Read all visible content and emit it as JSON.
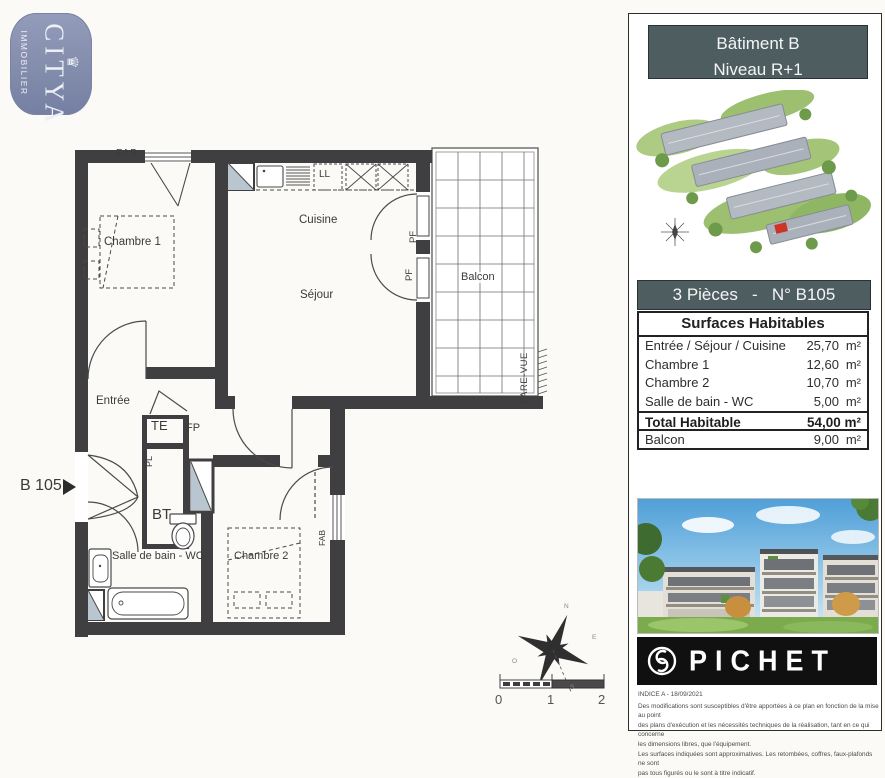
{
  "logo": {
    "brand": "CITYA",
    "sub": "IMMOBILIER",
    "crown": "♛"
  },
  "plan": {
    "unit_label": "B 105",
    "rooms": {
      "chambre1": "Chambre 1",
      "cuisine": "Cuisine",
      "sejour": "Séjour",
      "balcon": "Balcon",
      "entree": "Entrée",
      "sdb": "Salle de bain - WC",
      "chambre2": "Chambre 2"
    },
    "annotations": {
      "fab_top": "FAB",
      "fab_right": "FAB",
      "ll": "LL",
      "pf1": "PF",
      "pf2": "PF",
      "pare_vue": "PARE-VUE",
      "te": "TE",
      "fp": "FP",
      "pl": "PL",
      "bt": "BT"
    },
    "scale": {
      "t0": "0",
      "t1": "1",
      "t2": "2"
    },
    "compass": {
      "n": "N",
      "e": "E",
      "s": "S",
      "o": "O"
    }
  },
  "panel": {
    "header": {
      "line1": "Bâtiment B",
      "line2": "Niveau R+1"
    },
    "title": "3 Pièces   -   N° B105",
    "table": {
      "header": "Surfaces Habitables",
      "rows": [
        {
          "label": "Entrée / Séjour / Cuisine",
          "value": "25,70",
          "unit": "m²"
        },
        {
          "label": "Chambre 1",
          "value": "12,60",
          "unit": "m²"
        },
        {
          "label": "Chambre 2",
          "value": "10,70",
          "unit": "m²"
        },
        {
          "label": "Salle de bain - WC",
          "value": "5,00",
          "unit": "m²"
        }
      ],
      "total": {
        "label": "Total Habitable",
        "value": "54,00 m²"
      },
      "balcon": {
        "label": "Balcon",
        "value": "9,00",
        "unit": "m²"
      }
    },
    "brand": {
      "name": "PICHET"
    },
    "disclaimer": {
      "indice": "INDICE A - 18/09/2021",
      "lines": [
        "Des modifications sont susceptibles d'être apportées à ce plan en fonction de la mise au point",
        "des plans d'exécution et les nécessités techniques de la réalisation, tant en ce qui concerne",
        "les dimensions libres, que l'équipement.",
        "Les surfaces indiquées sont approximatives. Les retombées, coffres, faux-plafonds ne sont",
        "pas tous figurés ou le sont à titre indicatif."
      ]
    }
  }
}
